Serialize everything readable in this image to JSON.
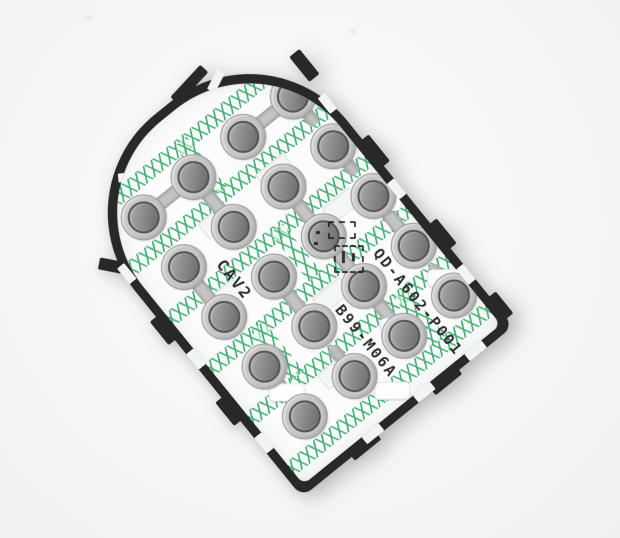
{
  "image": {
    "type": "product-photo",
    "subject": "Mobile phone keypad membrane circuit sheet with snap domes",
    "background_color": "#f5f6f6"
  },
  "membrane": {
    "frame_color": "#282828",
    "substrate_color": "#fcfcfc",
    "trace_lattice_color": "#46b26c",
    "dome_color": "#8e8e8e",
    "dome_count": 20,
    "dome_grid": {
      "columns": 4,
      "rows": 5
    },
    "markings": {
      "cavity_label": "CAV2",
      "part_number": "QD-A602-P001",
      "revision_code": "B99-M06A"
    }
  }
}
